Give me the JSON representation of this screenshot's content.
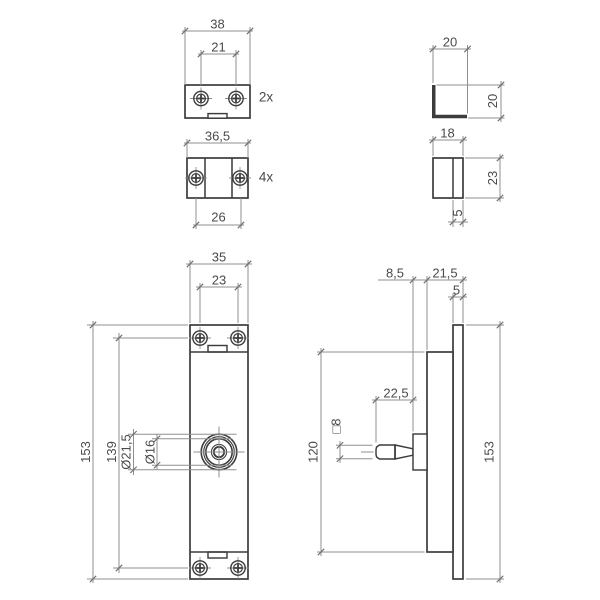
{
  "drawing": {
    "canvas": {
      "w": 600,
      "h": 600,
      "bg": "#ffffff"
    },
    "style": {
      "thick_color": "#3c3c3c",
      "thin_color": "#8f8f8f",
      "tick_color": "#6e6e6e",
      "text_color": "#4a4a4a",
      "thick_w": 1.7,
      "thin_w": 1,
      "font_size": 13
    },
    "quantities": {
      "top_clip": "2x",
      "bottom_clip": "4x"
    },
    "rects1": [
      [
        185,
        85,
        65,
        33
      ],
      [
        187,
        158,
        61,
        40
      ],
      [
        433,
        158,
        30,
        40
      ],
      [
        190,
        325,
        58,
        254
      ],
      [
        453,
        325,
        10,
        254
      ],
      [
        427,
        352,
        26,
        200
      ]
    ],
    "polys": [
      {
        "points": [
          [
            432,
            85
          ],
          [
            435.5,
            85
          ],
          [
            435.5,
            114.8
          ],
          [
            467,
            114.8
          ],
          [
            467,
            118.2
          ],
          [
            432,
            118.2
          ]
        ],
        "fill": "thick",
        "stroke": "none"
      },
      {
        "points": [
          [
            395,
            445
          ],
          [
            413,
            448.8
          ],
          [
            413,
            455.2
          ],
          [
            395,
            459
          ]
        ],
        "fill": "#ffffff",
        "stroke": "thick"
      },
      {
        "points": [
          [
            395,
            445
          ],
          [
            379.5,
            445
          ],
          [
            376.6,
            447
          ],
          [
            376,
            449.5
          ],
          [
            376,
            454.5
          ],
          [
            376.6,
            457
          ],
          [
            379.5,
            459
          ],
          [
            395,
            459
          ]
        ],
        "fill": "#ffffff",
        "stroke": "thick"
      }
    ],
    "rects2": [
      [
        208,
        113.6,
        19,
        4.6
      ],
      [
        208,
        345.5,
        19,
        6.5
      ],
      [
        208,
        552,
        19,
        6
      ],
      [
        413,
        434,
        14,
        36
      ]
    ],
    "thick_lines": [
      [
        205,
        158,
        205,
        198
      ],
      [
        232,
        158,
        232,
        198
      ],
      [
        453,
        158,
        453,
        198
      ],
      [
        190,
        352,
        248,
        352
      ],
      [
        190,
        552,
        248,
        552
      ],
      [
        395,
        445,
        395,
        459
      ]
    ],
    "circles": [
      [
        219,
        452,
        17.8,
        1.6
      ],
      [
        219,
        452,
        15.3,
        1.1
      ],
      [
        219,
        452,
        13.2,
        1.6
      ],
      [
        219,
        452,
        7.6,
        1.1
      ],
      [
        219,
        452,
        5.2,
        1.8
      ]
    ],
    "thin_lines": [
      [
        185,
        27,
        185,
        85
      ],
      [
        250,
        27,
        250,
        85
      ],
      [
        182,
        31,
        253,
        31
      ],
      [
        201,
        50,
        201,
        85
      ],
      [
        236,
        50,
        236,
        85
      ],
      [
        198,
        54,
        239,
        54
      ],
      [
        187,
        139,
        187,
        158
      ],
      [
        248,
        139,
        248,
        158
      ],
      [
        184,
        143,
        251,
        143
      ],
      [
        196,
        198,
        196,
        229
      ],
      [
        241,
        198,
        241,
        229
      ],
      [
        193,
        225,
        244,
        225
      ],
      [
        433,
        45,
        433,
        83
      ],
      [
        467.5,
        45,
        467.5,
        113.5
      ],
      [
        429,
        49,
        471,
        49
      ],
      [
        436.5,
        85,
        504.5,
        85
      ],
      [
        468,
        118,
        504.5,
        118
      ],
      [
        501,
        81,
        501,
        122
      ],
      [
        433,
        136,
        433,
        156
      ],
      [
        463,
        136,
        463,
        156
      ],
      [
        429,
        140,
        467,
        140
      ],
      [
        465,
        158,
        504,
        158
      ],
      [
        465,
        198,
        504,
        198
      ],
      [
        500,
        154,
        500,
        202
      ],
      [
        453,
        200,
        453,
        227
      ],
      [
        463,
        200,
        463,
        227
      ],
      [
        448,
        222,
        468,
        222
      ],
      [
        190,
        260,
        190,
        323
      ],
      [
        248,
        260,
        248,
        323
      ],
      [
        186,
        264,
        252,
        264
      ],
      [
        200,
        283,
        200,
        323
      ],
      [
        238,
        283,
        238,
        323
      ],
      [
        196,
        287,
        242,
        287
      ],
      [
        87,
        325,
        188,
        325
      ],
      [
        87,
        579,
        188,
        579
      ],
      [
        93,
        321,
        93,
        583
      ],
      [
        113,
        338,
        188,
        338
      ],
      [
        113,
        568,
        188,
        568
      ],
      [
        119,
        333,
        119,
        573
      ],
      [
        128,
        434.2,
        236.5,
        434.2
      ],
      [
        128,
        469.8,
        236.5,
        469.8
      ],
      [
        133.5,
        429,
        133.5,
        475
      ],
      [
        152,
        438.8,
        232,
        438.8
      ],
      [
        152,
        465.2,
        232,
        465.2
      ],
      [
        157,
        434,
        157,
        470
      ],
      [
        193.5,
        452,
        244.5,
        452
      ],
      [
        219,
        426.5,
        219,
        477.5
      ],
      [
        378,
        280,
        467,
        280
      ],
      [
        413,
        276,
        413,
        431.5
      ],
      [
        427,
        276,
        427,
        350
      ],
      [
        463,
        276,
        463,
        323
      ],
      [
        448,
        297,
        467,
        297
      ],
      [
        453,
        293,
        453,
        323
      ],
      [
        372,
        400,
        417,
        400
      ],
      [
        376,
        396,
        376,
        442.5
      ],
      [
        336,
        445.3,
        372.5,
        445.3
      ],
      [
        336,
        458.7,
        372.5,
        458.7
      ],
      [
        340,
        441,
        340,
        463
      ],
      [
        317,
        352,
        424.5,
        352
      ],
      [
        317,
        552,
        424.5,
        552
      ],
      [
        321,
        348,
        321,
        556
      ],
      [
        466,
        325,
        504,
        325
      ],
      [
        466,
        579,
        504,
        579
      ],
      [
        500,
        321,
        500,
        583
      ],
      [
        361,
        452,
        373.5,
        452
      ]
    ],
    "screws": [
      [
        201,
        98.5
      ],
      [
        236,
        98.5
      ],
      [
        196,
        178
      ],
      [
        240,
        178
      ],
      [
        200,
        338
      ],
      [
        238,
        338
      ],
      [
        200,
        568
      ],
      [
        238,
        568
      ]
    ],
    "ticks": [
      [
        185,
        31
      ],
      [
        250,
        31
      ],
      [
        201,
        54
      ],
      [
        236,
        54
      ],
      [
        187,
        143
      ],
      [
        248,
        143
      ],
      [
        196,
        225
      ],
      [
        241,
        225
      ],
      [
        433,
        49
      ],
      [
        467.5,
        49
      ],
      [
        501,
        85
      ],
      [
        501,
        118
      ],
      [
        433,
        140
      ],
      [
        463,
        140
      ],
      [
        500,
        158
      ],
      [
        500,
        198
      ],
      [
        453,
        222
      ],
      [
        463,
        222
      ],
      [
        190,
        264
      ],
      [
        248,
        264
      ],
      [
        200,
        287
      ],
      [
        238,
        287
      ],
      [
        93,
        325
      ],
      [
        93,
        579
      ],
      [
        119,
        338
      ],
      [
        119,
        568
      ],
      [
        133.5,
        434.2
      ],
      [
        133.5,
        469.8
      ],
      [
        157,
        438.8
      ],
      [
        157,
        465.2
      ],
      [
        413,
        280
      ],
      [
        427,
        280
      ],
      [
        463,
        280
      ],
      [
        453,
        297
      ],
      [
        463,
        297
      ],
      [
        376,
        400
      ],
      [
        413,
        400
      ],
      [
        340,
        445.3
      ],
      [
        340,
        458.7
      ],
      [
        321,
        352
      ],
      [
        321,
        552
      ],
      [
        500,
        325
      ],
      [
        500,
        579
      ]
    ],
    "texts": [
      {
        "t": "38",
        "x": 217.5,
        "y": 24,
        "rot": 0
      },
      {
        "t": "21",
        "x": 218.5,
        "y": 47,
        "rot": 0
      },
      {
        "t": "2x",
        "x": 266,
        "y": 97,
        "rot": 0,
        "size": 13.5
      },
      {
        "t": "36,5",
        "x": 217.5,
        "y": 136,
        "rot": 0
      },
      {
        "t": "26",
        "x": 218.5,
        "y": 217,
        "rot": 0
      },
      {
        "t": "4x",
        "x": 266,
        "y": 177,
        "rot": 0,
        "size": 13.5
      },
      {
        "t": "20",
        "x": 450,
        "y": 42,
        "rot": 0
      },
      {
        "t": "20",
        "x": 492.5,
        "y": 101,
        "rot": -90
      },
      {
        "t": "18",
        "x": 447.5,
        "y": 133,
        "rot": 0
      },
      {
        "t": "23",
        "x": 492.5,
        "y": 178,
        "rot": -90
      },
      {
        "t": "5",
        "x": 457.5,
        "y": 213,
        "rot": -90
      },
      {
        "t": "35",
        "x": 219,
        "y": 257,
        "rot": 0
      },
      {
        "t": "23",
        "x": 219,
        "y": 280,
        "rot": 0
      },
      {
        "t": "153",
        "x": 85.5,
        "y": 452,
        "rot": -90
      },
      {
        "t": "139",
        "x": 111.5,
        "y": 452,
        "rot": -90
      },
      {
        "t": "Ø21,5",
        "x": 126,
        "y": 452,
        "rot": -90
      },
      {
        "t": "Ø16",
        "x": 150,
        "y": 452,
        "rot": -90
      },
      {
        "t": "8,5",
        "x": 395,
        "y": 273,
        "rot": 0
      },
      {
        "t": "21,5",
        "x": 445,
        "y": 273,
        "rot": 0
      },
      {
        "t": "5",
        "x": 456.5,
        "y": 290,
        "rot": 0
      },
      {
        "t": "22,5",
        "x": 396,
        "y": 393,
        "rot": 0
      },
      {
        "t": "□8",
        "x": 336,
        "y": 426,
        "rot": -90
      },
      {
        "t": "120",
        "x": 313,
        "y": 452,
        "rot": -90
      },
      {
        "t": "153",
        "x": 489,
        "y": 452,
        "rot": -90
      }
    ]
  }
}
